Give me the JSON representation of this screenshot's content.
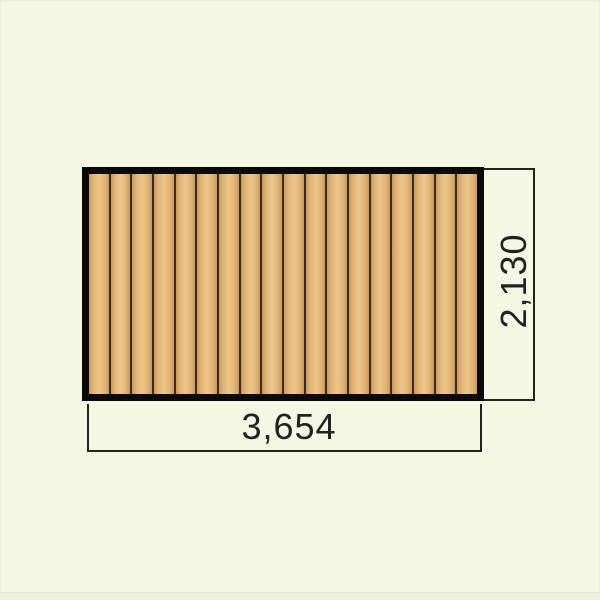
{
  "dimensions": {
    "width": {
      "label": "3,654"
    },
    "height": {
      "label": "2,130"
    }
  },
  "panel": {
    "plank_count": 18
  },
  "colors": {
    "background": "#f4f7e3",
    "frame_band": "#edf0da",
    "frame_line": "#fafcec",
    "panel_border": "#0a0a0a",
    "wood_edge": "#c7995e",
    "wood_mid": "#e2b577",
    "wood_center": "#edc58b",
    "wood_gap": "#3b2b19",
    "dimension_line": "#22221f",
    "dimension_text": "#222222"
  }
}
